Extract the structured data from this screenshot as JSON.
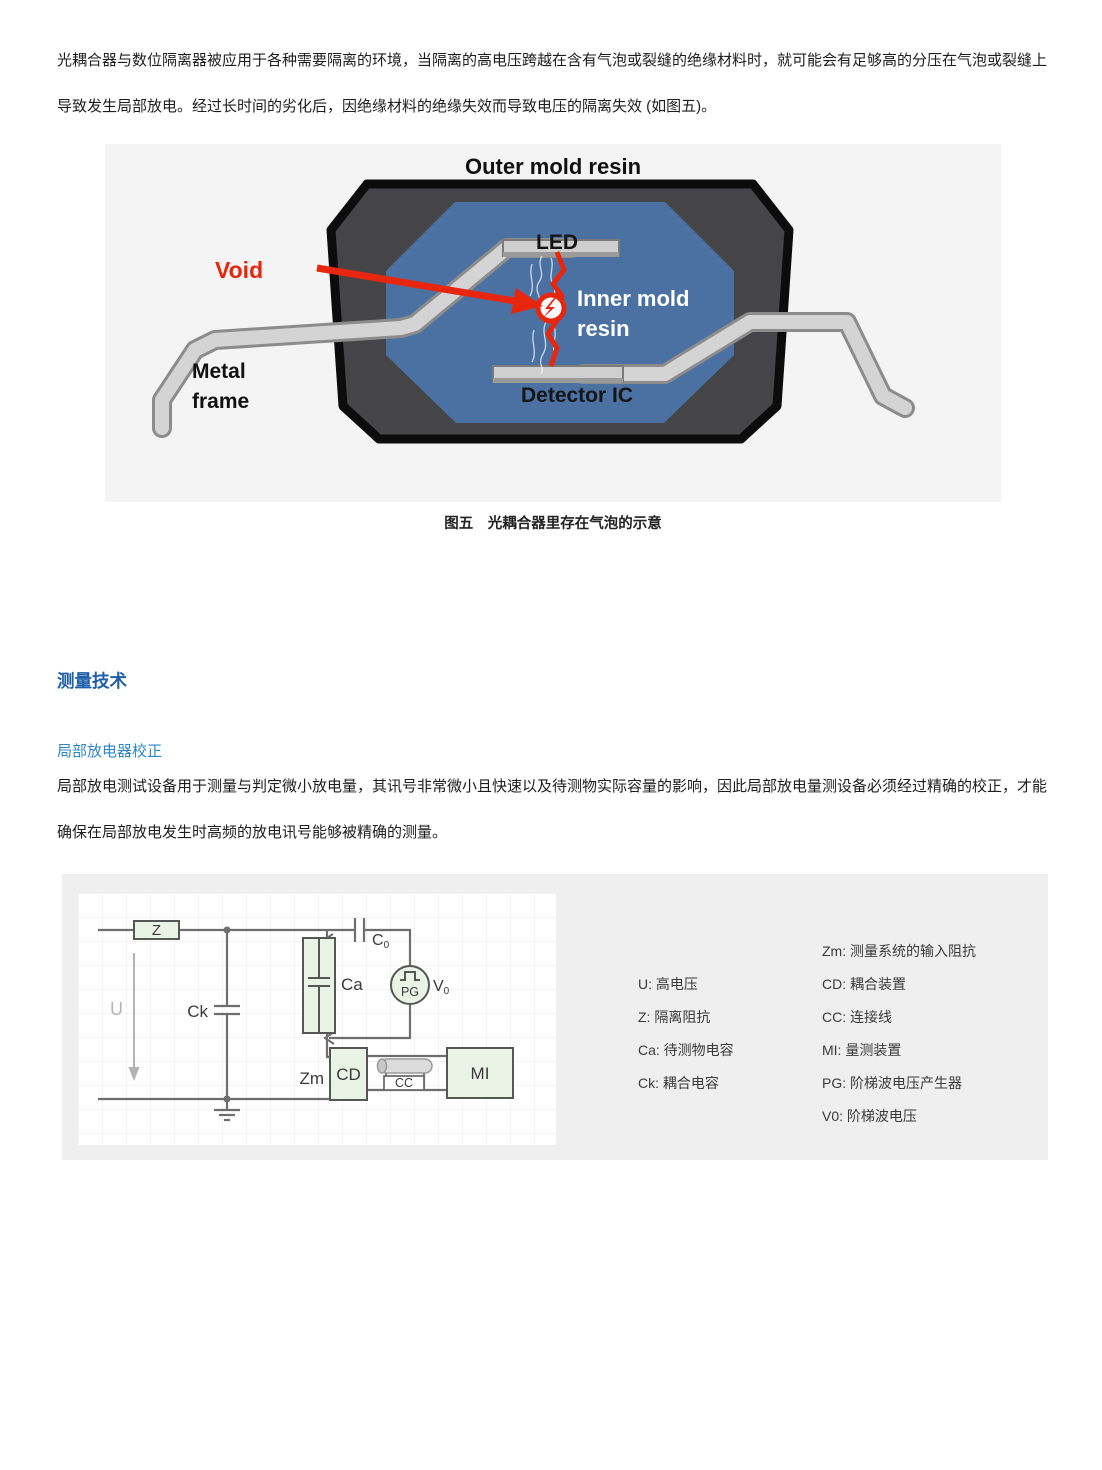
{
  "document": {
    "paragraph1": {
      "line1": "光耦合器与数位隔离器被应用于各种需要隔离的环境，当隔离的高电压跨越在含有气泡或裂缝的绝缘材料时，就可能会有足够高的分压在气泡或裂缝上",
      "line2": "导致发生局部放电。经过长时间的劣化后，因绝缘材料的绝缘失效而导致电压的隔离失效 (如图五)。"
    },
    "figure": {
      "caption": "图五　光耦合器里存在气泡的示意",
      "labels": {
        "outer_mold": "Outer mold resin",
        "led": "LED",
        "void": "Void",
        "inner_mold_1": "Inner mold",
        "inner_mold_2": "resin",
        "metal_1": "Metal",
        "metal_2": "frame",
        "detector": "Detector IC"
      }
    },
    "section_title": "测量技术",
    "subsection_title": "局部放电器校正",
    "paragraph2": {
      "line1": "局部放电测试设备用于测量与判定微小放电量，其讯号非常微小且快速以及待测物实际容量的影响，因此局部放电量测设备必须经过精确的校正，才能",
      "line2": "确保在局部放电发生时高频的放电讯号能够被精确的测量。"
    },
    "circuit": {
      "labels": {
        "z": "Z",
        "u": "U",
        "ck": "Ck",
        "ca": "Ca",
        "c0_main": "C",
        "c0_sub": "0",
        "pg": "PG",
        "v0_main": "V",
        "v0_sub": "0",
        "zm": "Zm",
        "cd": "CD",
        "cc": "CC",
        "mi": "MI"
      },
      "legend_left": [
        "U: 高电压",
        "Z: 隔离阻抗",
        "Ca: 待测物电容",
        "Ck: 耦合电容"
      ],
      "legend_right": [
        "Zm: 测量系统的输入阻抗",
        "CD: 耦合装置",
        "CC: 连接线",
        "MI: 量测装置",
        "PG: 阶梯波电压产生器",
        "V0: 阶梯波电压"
      ]
    },
    "colors": {
      "accent_blue": "#1e5fa9",
      "accent_light_blue": "#2e86c6",
      "separator_blue": "#1e88cf",
      "separator_green": "#6abf7d",
      "figure_red": "#e8260e",
      "inner_resin_blue": "#4b71a3",
      "package_dark": "#454548",
      "component_fill_green": "#e9f4e6"
    }
  }
}
